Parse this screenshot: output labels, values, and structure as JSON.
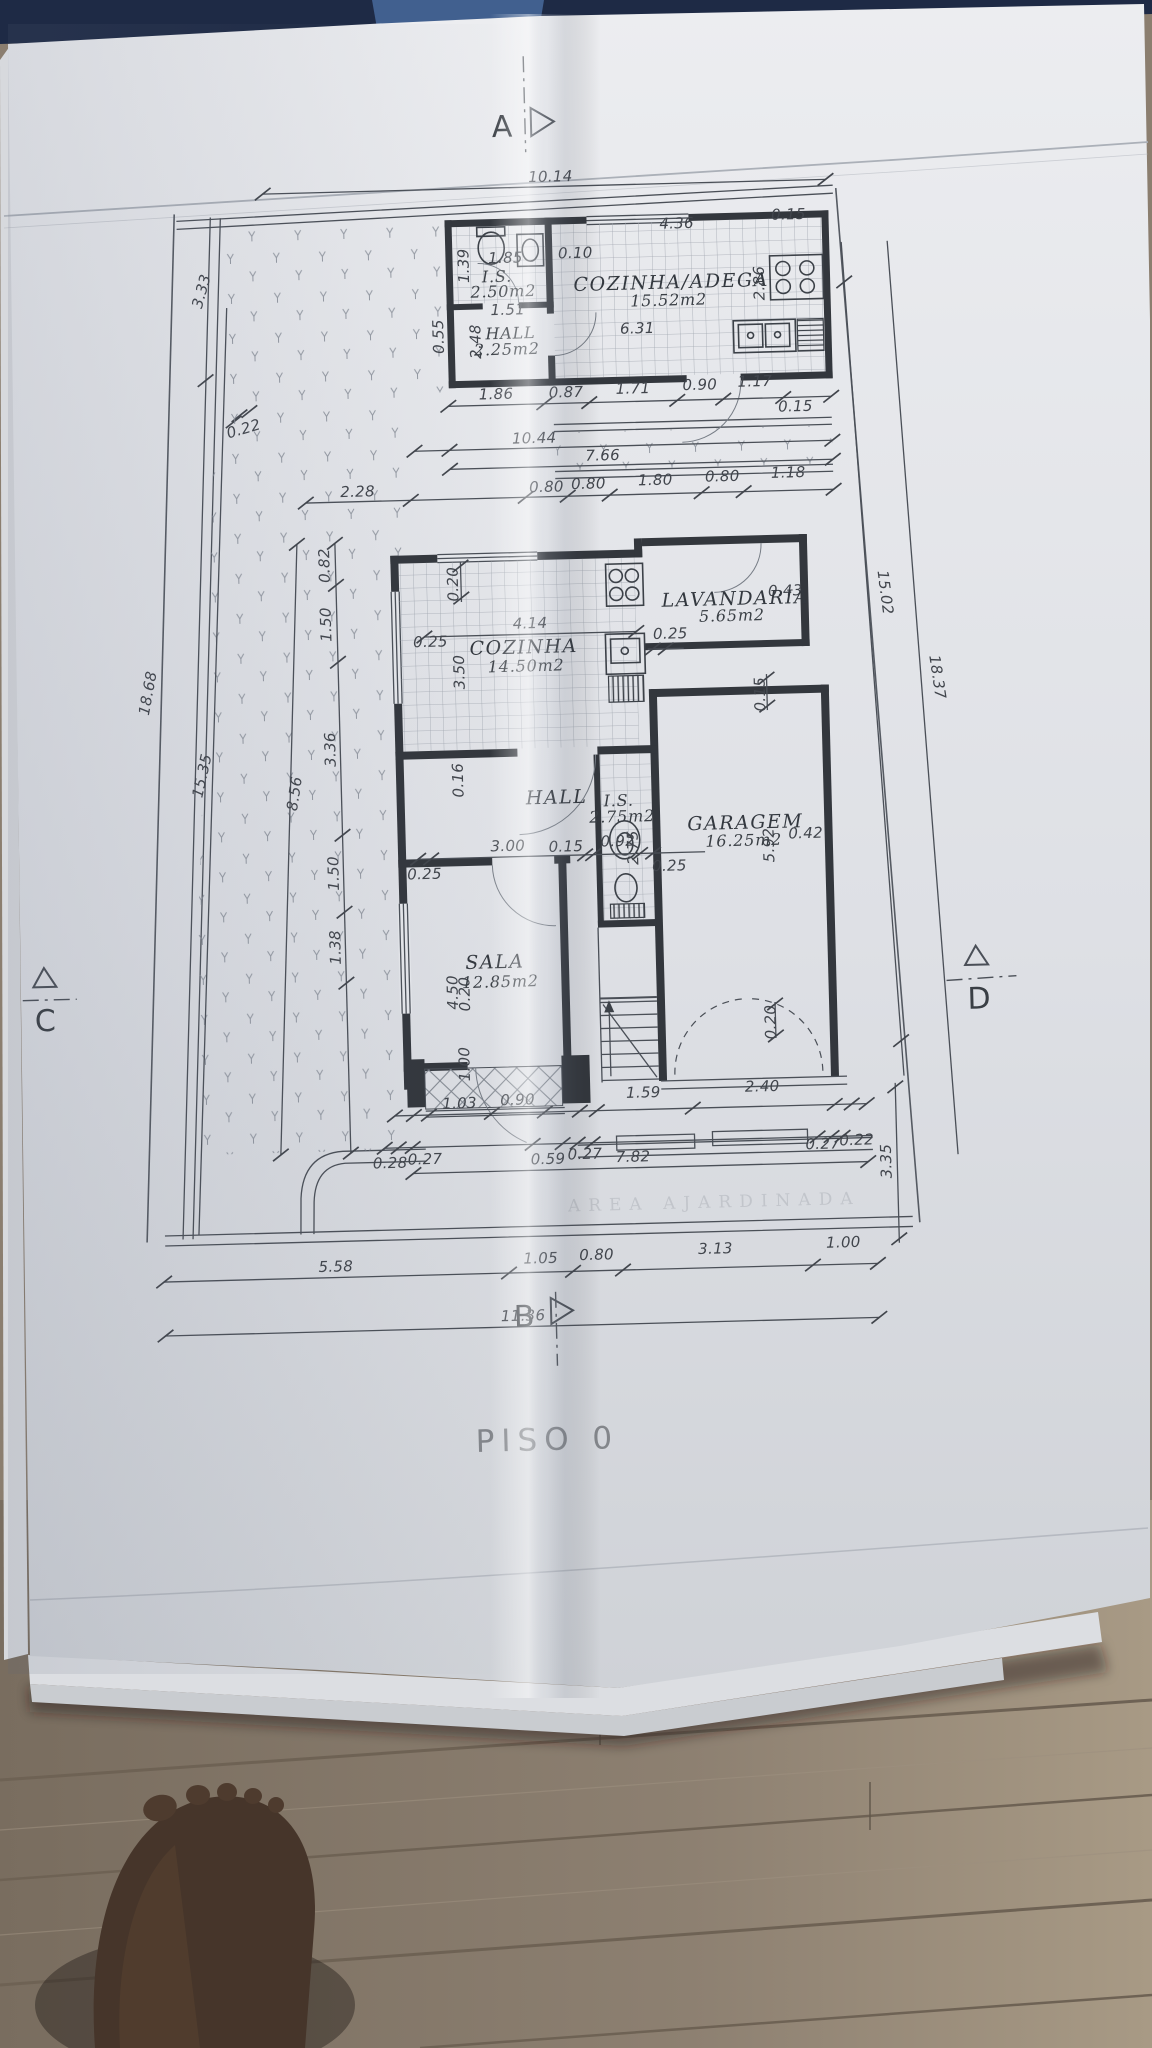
{
  "title": {
    "floor_title": "PISO  0"
  },
  "markers": {
    "a": "A",
    "b": "B",
    "c": "C",
    "d": "D"
  },
  "rooms": {
    "is_top": {
      "name": "I.S.",
      "area": "2.50m2"
    },
    "hall_top": {
      "name": "HALL",
      "area": "2.25m2"
    },
    "adega": {
      "name": "COZINHA/ADEGA",
      "area": "15.52m2"
    },
    "cozinha": {
      "name": "COZINHA",
      "area": "14.50m2"
    },
    "lavandaria": {
      "name": "LAVANDARIA",
      "area": "5.65m2"
    },
    "hall_mid": {
      "name": "HALL",
      "area": ""
    },
    "is_mid": {
      "name": "I.S.",
      "area": "2.75m2"
    },
    "garagem": {
      "name": "GARAGEM",
      "area": "16.25m2"
    },
    "sala": {
      "name": "SALA",
      "area": "12.85m2"
    }
  },
  "dims": {
    "top_width": "10.14",
    "annex": [
      "4.36",
      "0.15",
      "0.10",
      "2.86",
      "6.31",
      "1.85",
      "1.39",
      "1.51",
      "0.55",
      "2.48"
    ],
    "row1": [
      "1.86",
      "0.87",
      "1.71",
      "0.90",
      "1.17",
      "0.15"
    ],
    "row2": [
      "10.44",
      "7.66"
    ],
    "row3": [
      "2.28",
      "0.80",
      "0.80",
      "1.80",
      "0.80",
      "1.18"
    ],
    "kitchen": [
      "0.20",
      "0.25",
      "4.14",
      "3.50",
      "0.16"
    ],
    "laundry": [
      "0.43",
      "0.25",
      "0.15"
    ],
    "middle": [
      "0.92",
      "2.75",
      "0.25",
      "5.92",
      "0.42",
      "0.20"
    ],
    "sala": [
      "0.25",
      "3.00",
      "0.15",
      "4.50"
    ],
    "left": [
      "3.33",
      "0.22",
      "18.68",
      "15.35",
      "0.82",
      "1.50",
      "3.36",
      "8.56",
      "1.50",
      "1.38",
      "0.20",
      "1.00"
    ],
    "right": [
      "15.02",
      "18.37",
      "3.35"
    ],
    "entry": [
      "1.03",
      "0.90",
      "1.59",
      "2.40",
      "0.28",
      "0.27",
      "0.59",
      "0.27",
      "7.82",
      "0.27",
      "0.22"
    ],
    "bottom": [
      "5.58",
      "1.05",
      "0.80",
      "3.13",
      "1.00",
      "11.36"
    ]
  },
  "faded_text": "AREA  AJARDINADA",
  "colors": {
    "ink": "#3c4148",
    "paper": "#e6e8ec",
    "wood": "#8b7f71",
    "navy": "#1c2742"
  }
}
